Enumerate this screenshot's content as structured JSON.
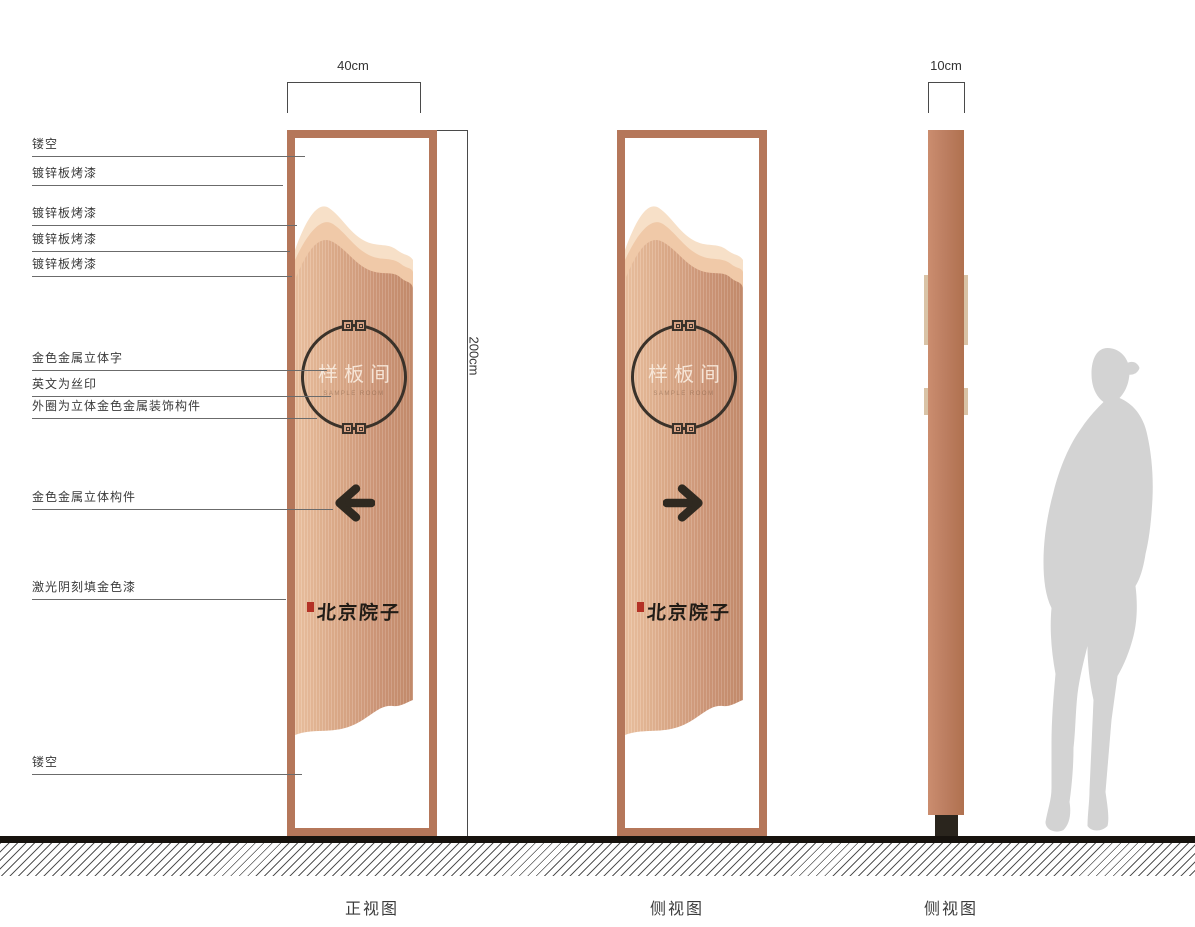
{
  "dimensions": {
    "front_width": "40cm",
    "height": "200cm",
    "profile_width": "10cm"
  },
  "views": [
    {
      "label": "正视图"
    },
    {
      "label": "侧视图"
    },
    {
      "label": "侧视图"
    }
  ],
  "callouts": [
    {
      "label": "镂空"
    },
    {
      "label": "镀锌板烤漆"
    },
    {
      "label": "镀锌板烤漆"
    },
    {
      "label": "镀锌板烤漆"
    },
    {
      "label": "镀锌板烤漆"
    },
    {
      "label": "金色金属立体字"
    },
    {
      "label": "英文为丝印"
    },
    {
      "label": "外圈为立体金色金属装饰构件"
    },
    {
      "label": "金色金属立体构件"
    },
    {
      "label": "激光阴刻填金色漆"
    },
    {
      "label": "镂空"
    }
  ],
  "plaque": {
    "title": "样板间",
    "subtitle": "SAMPLE ROOM"
  },
  "brand": {
    "name": "北京院子"
  },
  "colors": {
    "copper_frame": "#b5775a",
    "copper_panel": "#d3a081",
    "mountain_light": "#f7e0c8",
    "mountain_mid": "#f0c9a8",
    "emblem_dark": "#3a322a",
    "base_olive": "#4e4936",
    "seal_red": "#b43226",
    "silhouette_gray": "#d3d3d3",
    "ground_black": "#17130e"
  }
}
